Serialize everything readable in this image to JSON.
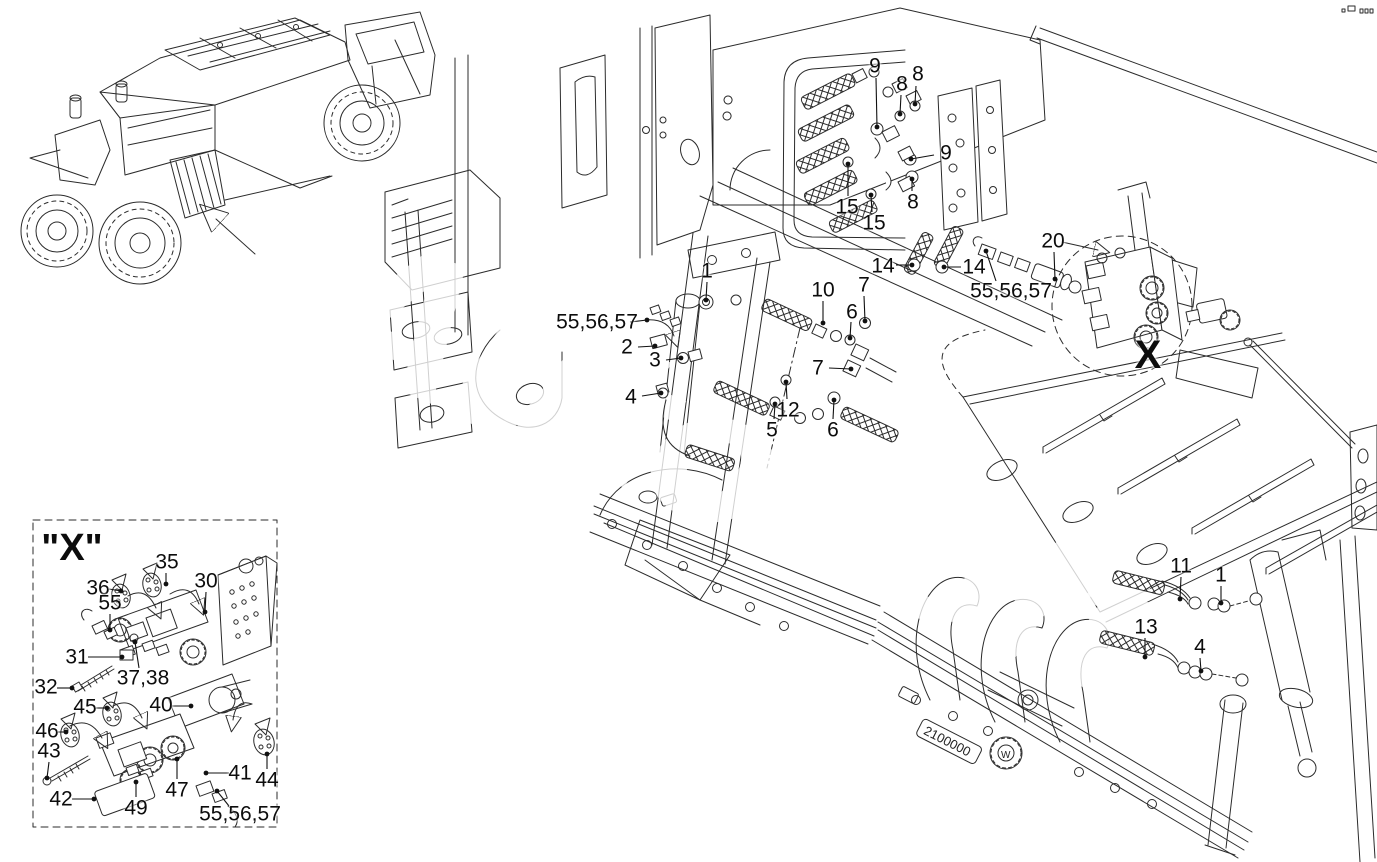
{
  "figure": {
    "watermark": "AutoSoft",
    "serial_plate": "2100000",
    "emblem_letter": "W",
    "detail_box_title": "\"X\""
  },
  "callouts": [
    {
      "t": "9",
      "x": 875,
      "y": 66,
      "l": [
        876,
        78,
        877,
        127
      ]
    },
    {
      "t": "8",
      "x": 902,
      "y": 84,
      "l": [
        901,
        95,
        900,
        114
      ]
    },
    {
      "t": "8",
      "x": 918,
      "y": 74,
      "l": [
        916,
        86,
        915,
        104
      ]
    },
    {
      "t": "9",
      "x": 946,
      "y": 153,
      "l": [
        934,
        155,
        911,
        159
      ]
    },
    {
      "t": "8",
      "x": 913,
      "y": 202,
      "l": [
        912,
        191,
        912,
        179
      ]
    },
    {
      "t": "15",
      "x": 847,
      "y": 207,
      "l": [
        848,
        196,
        848,
        164
      ]
    },
    {
      "t": "15",
      "x": 874,
      "y": 223,
      "l": [
        872,
        212,
        871,
        195
      ]
    },
    {
      "t": "14",
      "x": 883,
      "y": 266,
      "l": [
        896,
        265,
        912,
        265
      ]
    },
    {
      "t": "14",
      "x": 974,
      "y": 267,
      "l": [
        961,
        267,
        944,
        267
      ]
    },
    {
      "t": "20",
      "x": 1053,
      "y": 241,
      "l": [
        1054,
        252,
        1055,
        279
      ]
    },
    {
      "t": "55,56,57",
      "x": 1011,
      "y": 291,
      "l": [
        996,
        281,
        986,
        251
      ]
    },
    {
      "t": "55,56,57",
      "x": 597,
      "y": 322,
      "l": [
        630,
        322,
        647,
        320
      ]
    },
    {
      "t": "1",
      "x": 707,
      "y": 271,
      "l": [
        707,
        282,
        706,
        300
      ]
    },
    {
      "t": "10",
      "x": 823,
      "y": 290,
      "l": [
        823,
        301,
        823,
        323
      ]
    },
    {
      "t": "7",
      "x": 864,
      "y": 285,
      "l": [
        864,
        296,
        865,
        321
      ]
    },
    {
      "t": "6",
      "x": 852,
      "y": 312,
      "l": [
        851,
        322,
        850,
        338
      ]
    },
    {
      "t": "2",
      "x": 627,
      "y": 347,
      "l": [
        638,
        347,
        655,
        346
      ]
    },
    {
      "t": "3",
      "x": 655,
      "y": 360,
      "l": [
        666,
        360,
        681,
        358
      ]
    },
    {
      "t": "4",
      "x": 631,
      "y": 397,
      "l": [
        642,
        396,
        661,
        393
      ]
    },
    {
      "t": "7",
      "x": 818,
      "y": 368,
      "l": [
        829,
        368,
        851,
        369
      ]
    },
    {
      "t": "12",
      "x": 788,
      "y": 410,
      "l": [
        787,
        399,
        786,
        382
      ]
    },
    {
      "t": "5",
      "x": 772,
      "y": 430,
      "l": [
        774,
        419,
        775,
        404
      ]
    },
    {
      "t": "6",
      "x": 833,
      "y": 430,
      "l": [
        833,
        419,
        834,
        400
      ]
    },
    {
      "t": "X",
      "x": 1148,
      "y": 355,
      "fs": 40,
      "b": true
    },
    {
      "t": "11",
      "x": 1181,
      "y": 566,
      "l": [
        1181,
        577,
        1180,
        599
      ]
    },
    {
      "t": "1",
      "x": 1221,
      "y": 575,
      "l": [
        1221,
        586,
        1221,
        603
      ]
    },
    {
      "t": "13",
      "x": 1146,
      "y": 627,
      "l": [
        1145,
        638,
        1145,
        657
      ]
    },
    {
      "t": "4",
      "x": 1200,
      "y": 647,
      "l": [
        1200,
        658,
        1201,
        671
      ]
    },
    {
      "t": "\"X\"",
      "x": 72,
      "y": 548,
      "fs": 38,
      "b": true
    },
    {
      "t": "35",
      "x": 167,
      "y": 562,
      "l": [
        166,
        573,
        166,
        584
      ]
    },
    {
      "t": "36",
      "x": 98,
      "y": 588,
      "l": [
        109,
        589,
        121,
        591
      ]
    },
    {
      "t": "30",
      "x": 206,
      "y": 581,
      "l": [
        206,
        592,
        205,
        612
      ]
    },
    {
      "t": "55",
      "x": 110,
      "y": 603,
      "l": [
        110,
        614,
        110,
        630
      ]
    },
    {
      "t": "31",
      "x": 77,
      "y": 657,
      "l": [
        88,
        657,
        122,
        657
      ]
    },
    {
      "t": "32",
      "x": 46,
      "y": 687,
      "l": [
        57,
        688,
        72,
        688
      ]
    },
    {
      "t": "37,38",
      "x": 143,
      "y": 678,
      "l": [
        139,
        668,
        135,
        642
      ]
    },
    {
      "t": "45",
      "x": 85,
      "y": 707,
      "l": [
        96,
        708,
        107,
        708
      ]
    },
    {
      "t": "40",
      "x": 161,
      "y": 705,
      "l": [
        172,
        706,
        191,
        706
      ]
    },
    {
      "t": "46",
      "x": 47,
      "y": 731,
      "l": [
        58,
        732,
        66,
        732
      ]
    },
    {
      "t": "43",
      "x": 49,
      "y": 751,
      "l": [
        49,
        762,
        47,
        778
      ]
    },
    {
      "t": "42",
      "x": 61,
      "y": 799,
      "l": [
        72,
        799,
        94,
        799
      ]
    },
    {
      "t": "49",
      "x": 136,
      "y": 808,
      "l": [
        136,
        797,
        136,
        782
      ]
    },
    {
      "t": "47",
      "x": 177,
      "y": 790,
      "l": [
        177,
        779,
        177,
        759
      ]
    },
    {
      "t": "41",
      "x": 240,
      "y": 773,
      "l": [
        229,
        773,
        206,
        773
      ]
    },
    {
      "t": "44",
      "x": 267,
      "y": 780,
      "l": [
        267,
        769,
        267,
        754
      ]
    },
    {
      "t": "55,56,57",
      "x": 240,
      "y": 814,
      "l": [
        229,
        806,
        217,
        791
      ]
    }
  ]
}
